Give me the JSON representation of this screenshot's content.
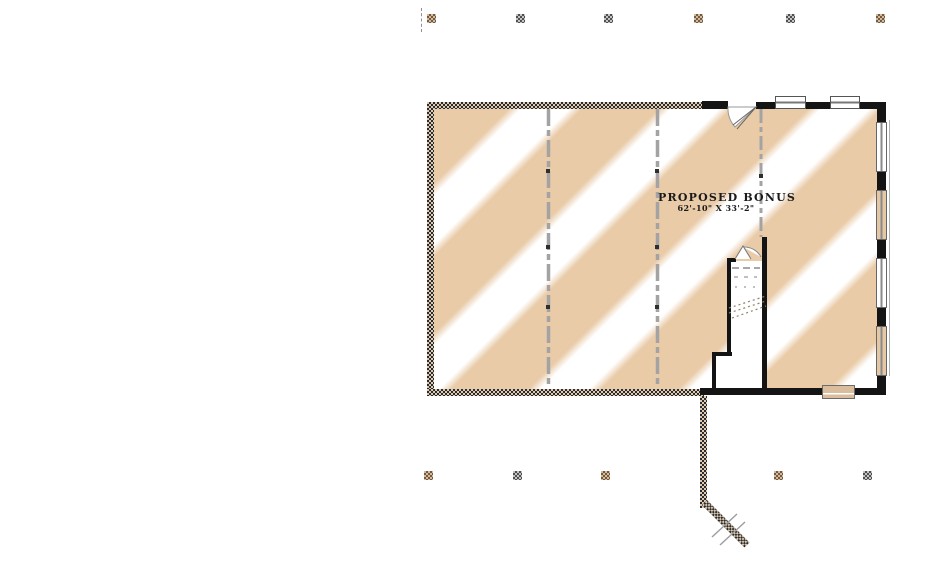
{
  "plan": {
    "room_label": "PROPOSED BONUS",
    "room_dimensions": "62'-10\" X 33'-2\"",
    "colors": {
      "stripe_tan": "#e9cba8",
      "paper_white": "#ffffff",
      "wall_black": "#141414",
      "hatch_dark": "#2b2b2b",
      "hatch_tan": "#dccab2",
      "dashed_beam_gray": "#a3a3a3",
      "window_tint_tan": "#e4c7a5"
    }
  }
}
